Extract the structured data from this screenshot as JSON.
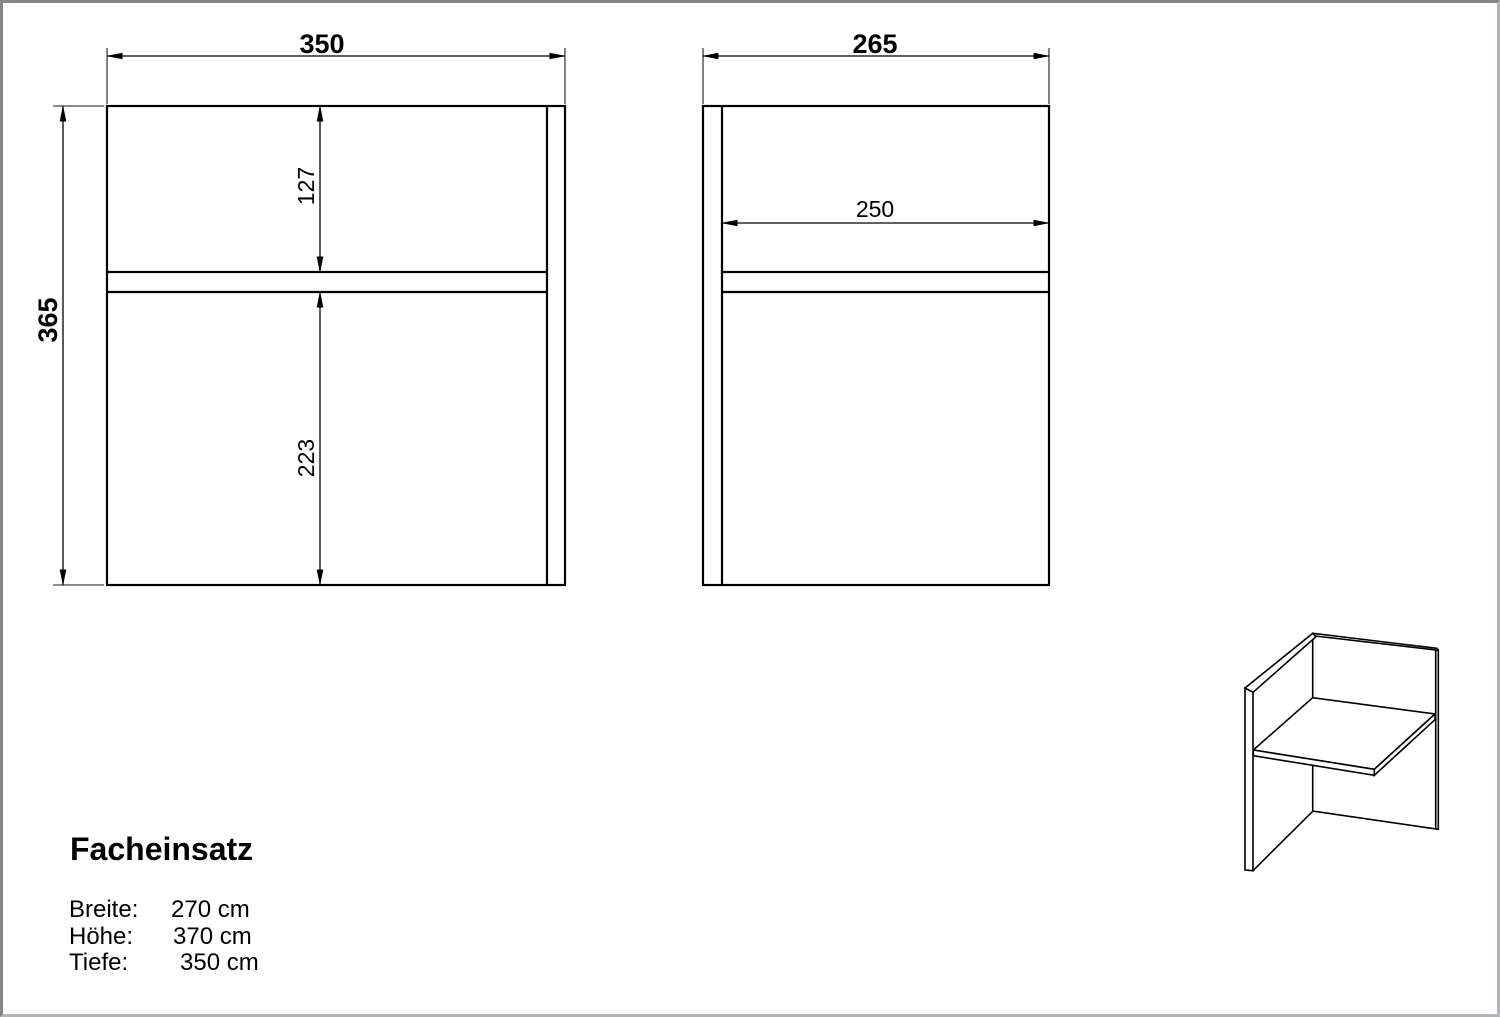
{
  "product": {
    "name": "Facheinsatz",
    "specs": [
      {
        "label": "Breite:",
        "value": "270 cm"
      },
      {
        "label": "Höhe:",
        "value": "370 cm"
      },
      {
        "label": "Tiefe:",
        "value": "350 cm"
      }
    ]
  },
  "drawing": {
    "front_view": {
      "overall_width": "350",
      "overall_height": "365",
      "upper_compartment_height": "127",
      "lower_compartment_height": "223"
    },
    "side_view": {
      "overall_depth": "265",
      "shelf_depth": "250"
    }
  },
  "colors": {
    "line": "#000000",
    "background": "#ffffff",
    "frame_top_left": "#85858a",
    "frame_bottom_right": "#b4b4b8"
  }
}
